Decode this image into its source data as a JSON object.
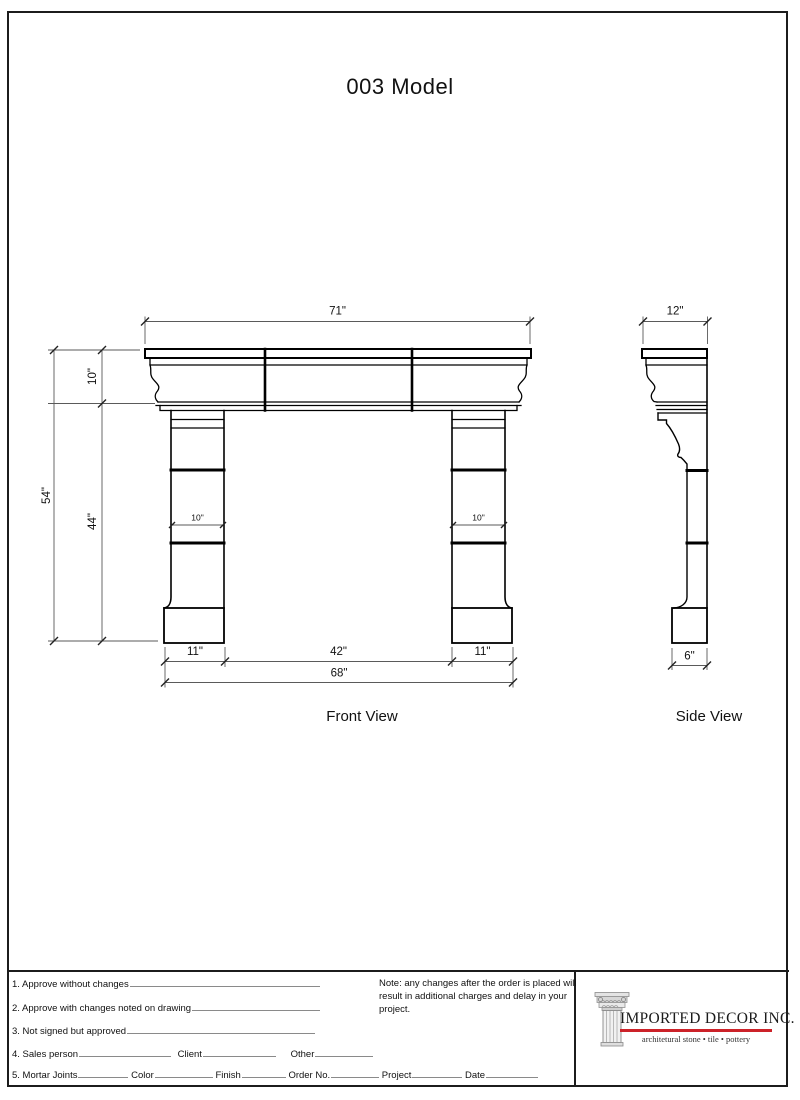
{
  "title": "003 Model",
  "front": {
    "label": "Front View",
    "dim_71": "71\"",
    "dim_10_shelf": "10\"",
    "dim_54": "54\"",
    "dim_44": "44\"",
    "dim_10_left_leg": "10\"",
    "dim_10_right_leg": "10\"",
    "dim_11_left": "11\"",
    "dim_42": "42\"",
    "dim_11_right": "11\"",
    "dim_68": "68\""
  },
  "side": {
    "label": "Side View",
    "dim_12": "12\"",
    "dim_6": "6\""
  },
  "form": {
    "row1": "1. Approve without changes",
    "row2": "2. Approve with changes noted on drawing",
    "row3": "3. Not signed but approved",
    "row4_sales": "4. Sales person",
    "row4_client": "Client",
    "row4_other": "Other",
    "row5_mortar": "5. Mortar Joints",
    "row5_color": "Color",
    "row5_finish": "Finish",
    "row5_order": "Order No.",
    "row5_project": "Project",
    "row5_date": "Date",
    "note": "Note: any changes after the order is placed will result in additional charges and delay in your project."
  },
  "logo": {
    "company": "IMPORTED DECOR INC.",
    "tagline": "architetural stone • tile • pottery",
    "accent_color": "#cc2229",
    "icon": "classical-column-icon"
  }
}
